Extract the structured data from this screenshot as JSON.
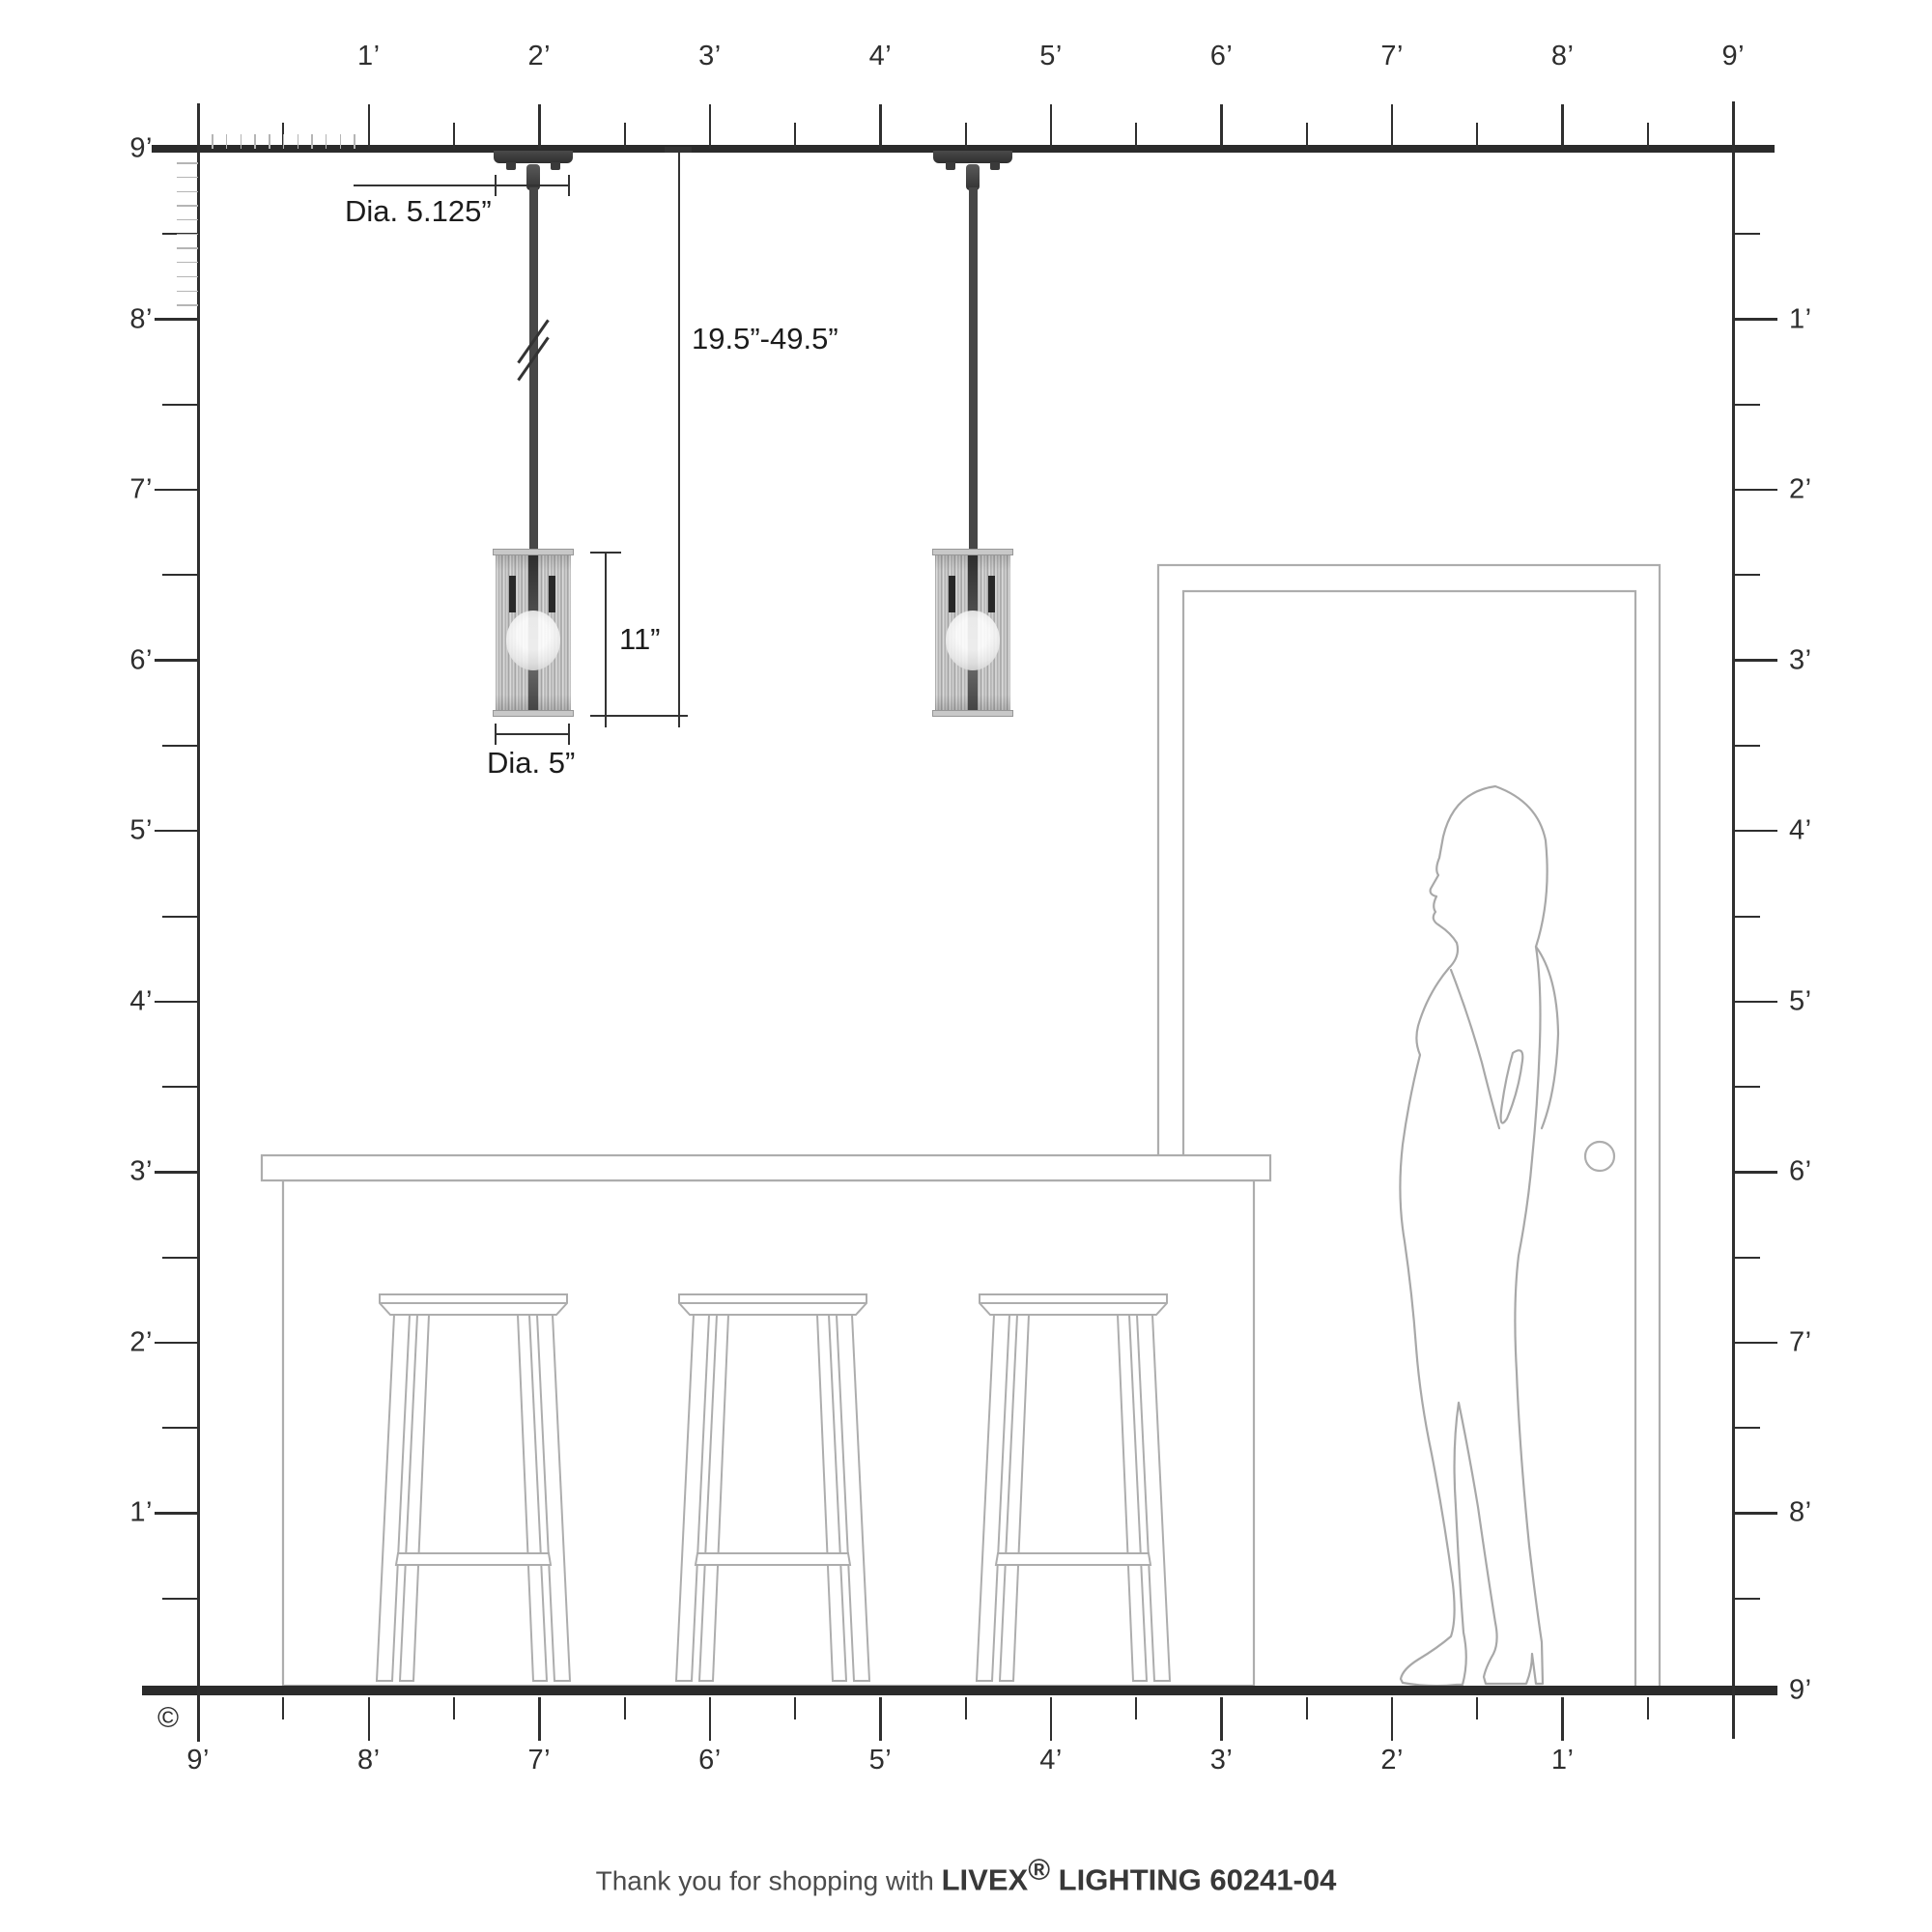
{
  "title": "Livex Lighting pendant scale diagram",
  "rulers": {
    "top": {
      "labels": [
        "1’",
        "2’",
        "3’",
        "4’",
        "5’",
        "6’",
        "7’",
        "8’",
        "9’"
      ]
    },
    "left": {
      "ceiling_label": "9’",
      "labels": [
        "8’",
        "7’",
        "6’",
        "5’",
        "4’",
        "3’",
        "2’",
        "1’"
      ]
    },
    "right": {
      "labels": [
        "1’",
        "2’",
        "3’",
        "4’",
        "5’",
        "6’",
        "7’",
        "8’"
      ],
      "floor_label": "9’"
    },
    "bottom": {
      "labels": [
        "9’",
        "8’",
        "7’",
        "6’",
        "5’",
        "4’",
        "3’",
        "2’",
        "1’"
      ]
    }
  },
  "dimensions": {
    "canopy_diameter": "Dia. 5.125”",
    "overall_drop": "19.5”-49.5”",
    "shade_height": "11”",
    "shade_diameter": "Dia. 5”"
  },
  "footer": {
    "prefix": "Thank you for shopping with ",
    "brand": "LIVEX",
    "registered": "®",
    "product": " LIGHTING 60241-04"
  },
  "copyright_symbol": "©",
  "colors": {
    "line_dark": "#2b2b2b",
    "fixture_dark": "#3a3a3a",
    "furniture_gray": "#adadad",
    "silhouette_gray": "#a8a8a8",
    "inch_tick_gray": "#b5b5b5"
  },
  "scene": {
    "pendant_count": 2,
    "stool_count": 3,
    "objects": [
      "pendant-light",
      "pendant-light",
      "kitchen-island",
      "bar-stool",
      "bar-stool",
      "bar-stool",
      "door",
      "woman-silhouette"
    ]
  }
}
